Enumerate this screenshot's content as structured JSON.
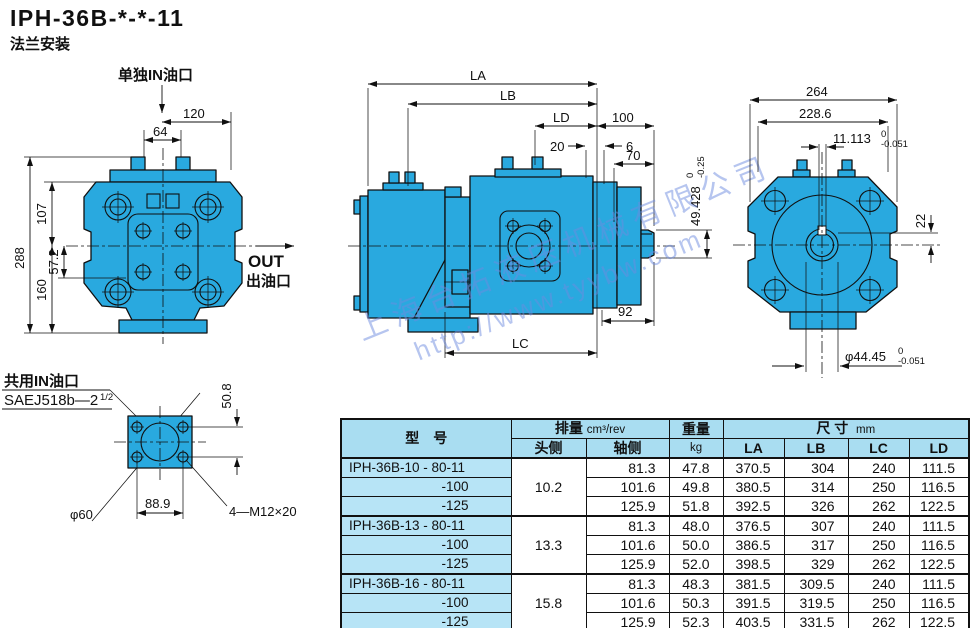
{
  "page": {
    "title": "IPH-36B-*-*-11",
    "subtitle": "法兰安装"
  },
  "colors": {
    "pump_body": "#29a9df",
    "table_header_bg": "#a9ddf1",
    "model_col_bg": "#b7e4f6",
    "watermark": "#6e8cdf",
    "line": "#101010"
  },
  "watermark": {
    "company": "上海台拓液压机械有限公司",
    "url": "http://www.tyybw.com"
  },
  "front_view": {
    "port_label": "单独IN油口",
    "out_label": "OUT",
    "out_label_cn": "出油口",
    "dims": {
      "w120": "120",
      "w64": "64",
      "h288": "288",
      "h107": "107",
      "h160": "160",
      "h57_2": "57.2"
    }
  },
  "flange_view": {
    "port_label": "共用IN油口",
    "spec_label": "SAEJ518b—2",
    "spec_frac": "1/2",
    "dims": {
      "h50_8": "50.8",
      "d60": "φ60",
      "w88_9": "88.9",
      "bolts": "4—M12×20"
    }
  },
  "side_view": {
    "dims": {
      "la": "LA",
      "lb": "LB",
      "ld": "LD",
      "n100": "100",
      "n20": "20",
      "n6": "6",
      "n70": "70",
      "n92": "92",
      "lc": "LC",
      "key_h": "49.428",
      "key_h_tol_u": "0",
      "key_h_tol_l": "-0.25"
    }
  },
  "rear_view": {
    "dims": {
      "w264": "264",
      "w228_6": "228.6",
      "key_w": "11.113",
      "key_w_tol_u": "0",
      "key_w_tol_l": "-0.051",
      "n22": "22",
      "shaft_d": "φ44.45",
      "shaft_d_tol_u": "0",
      "shaft_d_tol_l": "-0.051"
    }
  },
  "table": {
    "headers": {
      "model": "型　号",
      "displacement": "排量",
      "displacement_unit": "cm³/rev",
      "head_side": "头侧",
      "shaft_side": "轴侧",
      "weight": "重量",
      "weight_unit": "kg",
      "size": "尺 寸",
      "size_unit": "mm",
      "la": "LA",
      "lb": "LB",
      "lc": "LC",
      "ld": "LD"
    },
    "rows": [
      {
        "model": "IPH-36B-10 - 80-11",
        "head": "10.2",
        "shaft": "81.3",
        "weight": "47.8",
        "la": "370.5",
        "lb": "304",
        "lc": "240",
        "ld": "111.5"
      },
      {
        "model": "-100",
        "shaft": "101.6",
        "weight": "49.8",
        "la": "380.5",
        "lb": "314",
        "lc": "250",
        "ld": "116.5"
      },
      {
        "model": "-125",
        "shaft": "125.9",
        "weight": "51.8",
        "la": "392.5",
        "lb": "326",
        "lc": "262",
        "ld": "122.5"
      },
      {
        "model": "IPH-36B-13 - 80-11",
        "head": "13.3",
        "shaft": "81.3",
        "weight": "48.0",
        "la": "376.5",
        "lb": "307",
        "lc": "240",
        "ld": "111.5"
      },
      {
        "model": "-100",
        "shaft": "101.6",
        "weight": "50.0",
        "la": "386.5",
        "lb": "317",
        "lc": "250",
        "ld": "116.5"
      },
      {
        "model": "-125",
        "shaft": "125.9",
        "weight": "52.0",
        "la": "398.5",
        "lb": "329",
        "lc": "262",
        "ld": "122.5"
      },
      {
        "model": "IPH-36B-16 - 80-11",
        "head": "15.8",
        "shaft": "81.3",
        "weight": "48.3",
        "la": "381.5",
        "lb": "309.5",
        "lc": "240",
        "ld": "111.5"
      },
      {
        "model": "-100",
        "shaft": "101.6",
        "weight": "50.3",
        "la": "391.5",
        "lb": "319.5",
        "lc": "250",
        "ld": "116.5"
      },
      {
        "model": "-125",
        "shaft": "125.9",
        "weight": "52.3",
        "la": "403.5",
        "lb": "331.5",
        "lc": "262",
        "ld": "122.5"
      }
    ]
  }
}
